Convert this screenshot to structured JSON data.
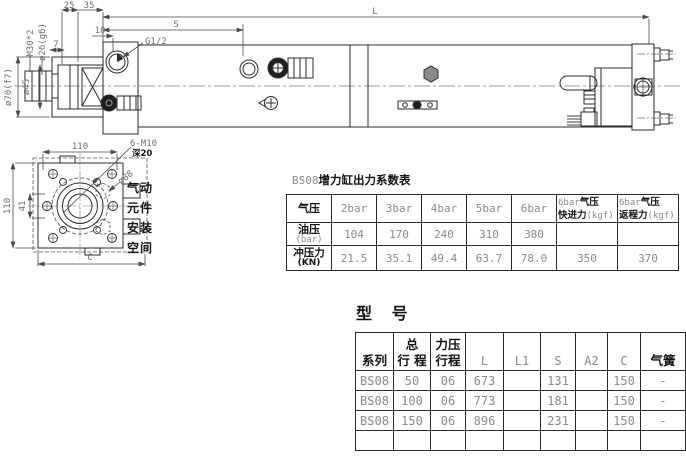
{
  "drawing": {
    "side_view": {
      "labels": {
        "dim25": "25",
        "dim35": "35",
        "dim10": "10",
        "dimS": "S",
        "dimL": "L",
        "port": "G1/2",
        "thread": "M30*2",
        "rod": "ø26(g6)",
        "dim7": "7",
        "dia45": "ø45",
        "dia70": "ø70(f7)"
      }
    },
    "end_view": {
      "labels": {
        "dim110_top": "110",
        "dim110_left": "110",
        "dim41": "41",
        "dimC": "C",
        "bolts": "6-M10",
        "depth": "深20",
        "dia88": "ø88"
      },
      "note": [
        "气动",
        "元件",
        "安装",
        "空间"
      ]
    }
  },
  "coeff_table": {
    "title_prefix": "BS08",
    "title": "增力缸出力系数表",
    "row1": {
      "label": "气压",
      "cols": [
        "2bar",
        "3bar",
        "4bar",
        "5bar",
        "6bar"
      ]
    },
    "col7": {
      "l1a": "6bar",
      "l1b": "气压",
      "l2a": "快进力",
      "l2b": "(kgf)"
    },
    "col8": {
      "l1a": "6bar",
      "l1b": "气压",
      "l2a": "返程力",
      "l2b": "(kgf)"
    },
    "row2": {
      "label": "油压",
      "unit": "(bar)",
      "values": [
        "104",
        "170",
        "240",
        "310",
        "380",
        "",
        ""
      ]
    },
    "row3": {
      "label": "冲压力",
      "unit": "(KN)",
      "values": [
        "21.5",
        "35.1",
        "49.4",
        "63.7",
        "78.0",
        "350",
        "370"
      ]
    }
  },
  "model_table": {
    "title": "型 号",
    "headers": [
      {
        "l1": "",
        "l2": "系列"
      },
      {
        "l1": "总",
        "l2": "行 程"
      },
      {
        "l1": "力压",
        "l2": "行程"
      },
      {
        "l1": "",
        "l2": "L"
      },
      {
        "l1": "",
        "l2": "L1"
      },
      {
        "l1": "",
        "l2": "S"
      },
      {
        "l1": "",
        "l2": "A2"
      },
      {
        "l1": "",
        "l2": "C"
      },
      {
        "l1": "",
        "l2": "气簧"
      }
    ],
    "rows": [
      [
        "BS08",
        "50",
        "06",
        "673",
        "",
        "131",
        "",
        "150",
        "-"
      ],
      [
        "BS08",
        "100",
        "06",
        "773",
        "",
        "181",
        "",
        "150",
        "-"
      ],
      [
        "BS08",
        "150",
        "06",
        "896",
        "",
        "231",
        "",
        "150",
        "-"
      ],
      [
        "",
        "",
        "",
        "",
        "",
        "",
        "",
        "",
        ""
      ]
    ]
  },
  "colors": {
    "background": "#ffffff",
    "line": "#2b2b2b",
    "dim_line": "#4a4a4a",
    "cad_text": "#8a8a8a",
    "bold_text": "#141414"
  }
}
